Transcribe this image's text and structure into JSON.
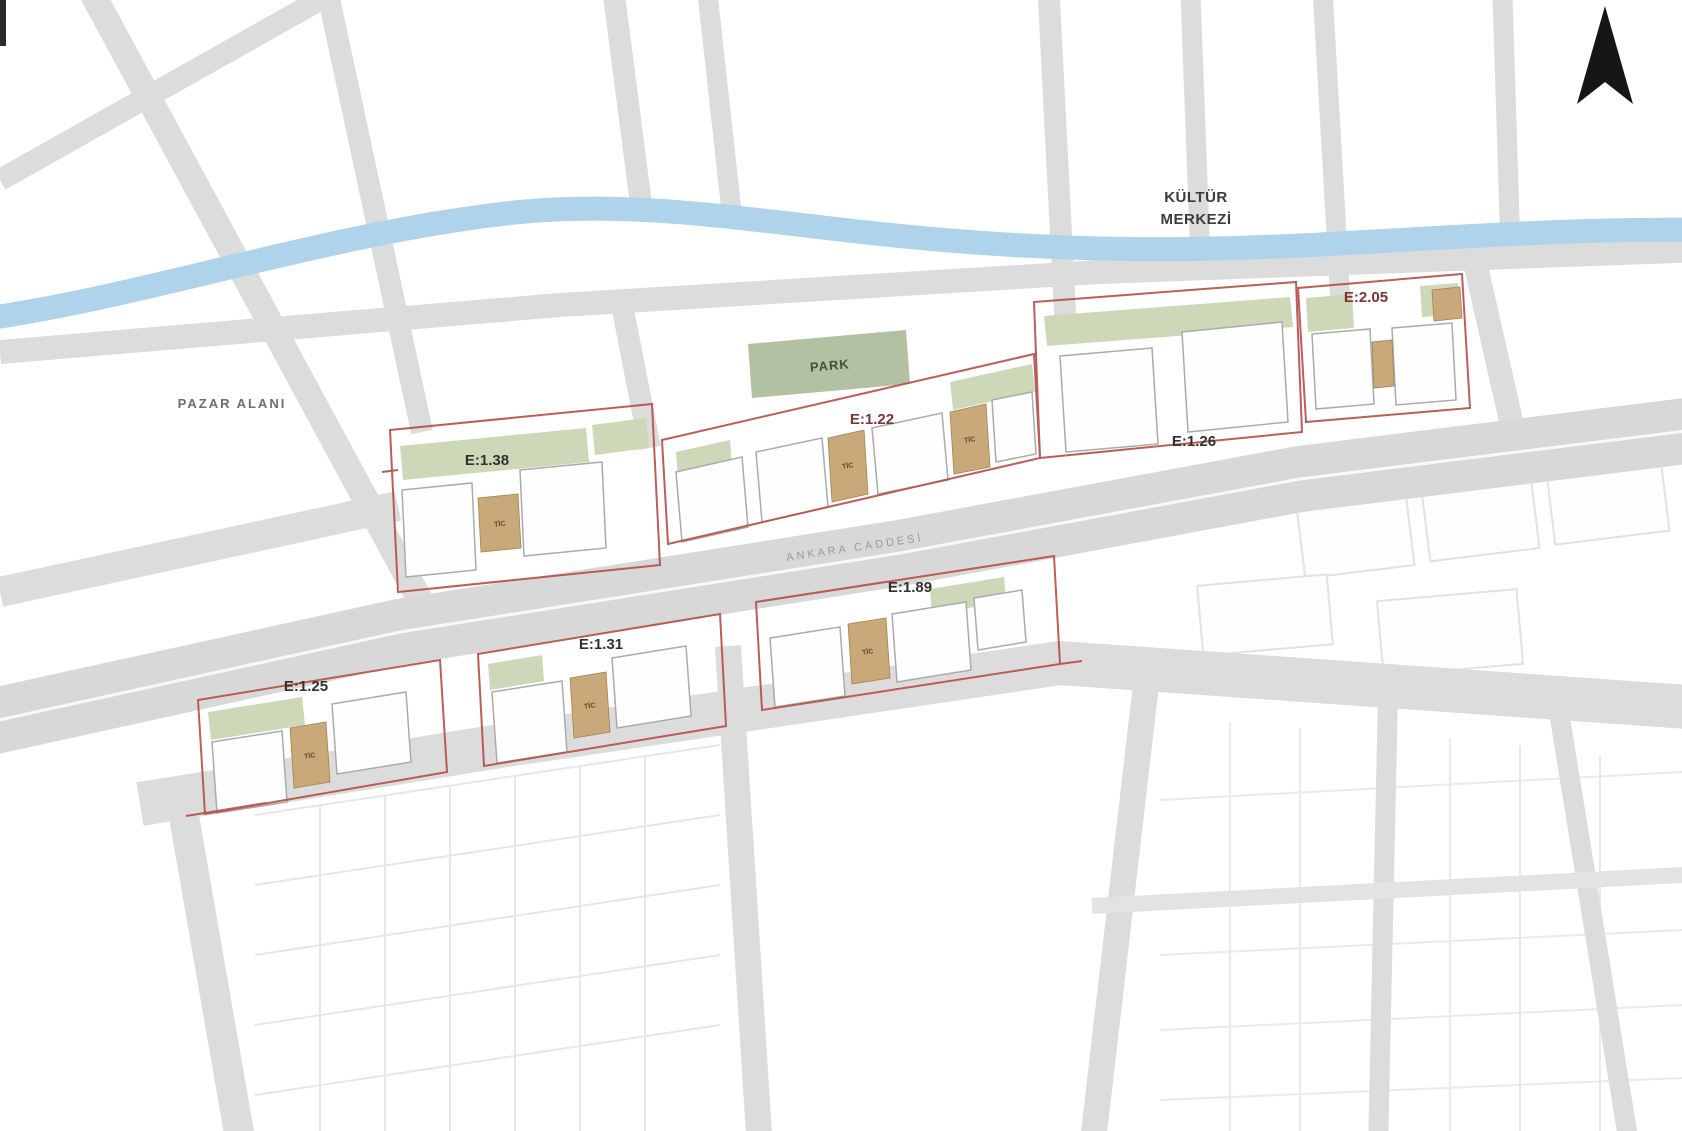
{
  "labels": {
    "pazar": "PAZAR ALANI",
    "kultur_line1": "KÜLTÜR",
    "kultur_line2": "MERKEZİ",
    "park": "PARK",
    "street": "ANKARA CADDESİ",
    "tic": "TİC"
  },
  "parcels": [
    {
      "id": "upper-1",
      "far": "E:1.38"
    },
    {
      "id": "upper-2",
      "far": "E:1.22"
    },
    {
      "id": "upper-3",
      "far": "E:1.26"
    },
    {
      "id": "upper-4",
      "far": "E:2.05"
    },
    {
      "id": "lower-1",
      "far": "E:1.25"
    },
    {
      "id": "lower-2",
      "far": "E:1.31"
    },
    {
      "id": "lower-3",
      "far": "E:1.89"
    }
  ],
  "icons": {
    "north_arrow": "▲"
  },
  "colors": {
    "road": "#dcdcdc",
    "avenue": "#d8d8d8",
    "river": "#aed3eb",
    "parcel_boundary": "#b8504c",
    "building_fill": "#fefefe",
    "building_stroke": "#ababab",
    "commercial_fill": "#c9a979",
    "green_fill": "#ccd8b8",
    "park_fill": "#b2c1a2",
    "far_label_dark": "#33302e",
    "far_label_red": "#7e3432",
    "north_arrow": "#161616"
  }
}
